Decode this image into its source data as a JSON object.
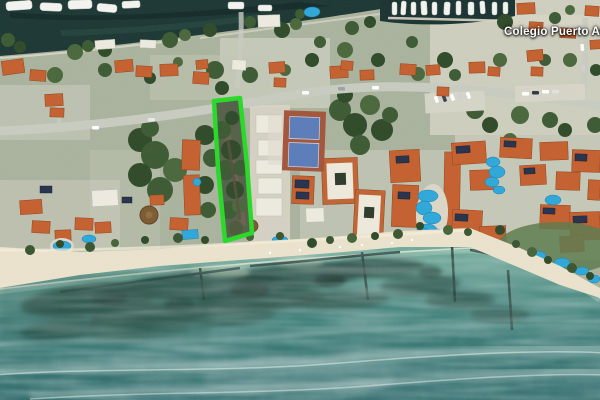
{
  "map": {
    "place_label": {
      "text": "Colegio Puerto Aven",
      "color": "#ffffff"
    },
    "overlay": {
      "name": "highlighted-parcel-outline",
      "stroke_color": "#2bd92b",
      "stroke_width": 4.5
    },
    "colors": {
      "highlight_green": "#2bd92b",
      "ocean_shallow": "#74ac9c",
      "ocean_mid": "#41807a",
      "ocean_deep": "#2f6a6b",
      "canal_water": "#1d3734",
      "beach_sand": "#e9e1cb",
      "roof_orange": "#c3602f",
      "pool_blue": "#2fa7d8",
      "tennis_blue": "#5b7cb8",
      "road_gray": "#c7cbbf",
      "reef_dark": "#2a4f46"
    }
  }
}
